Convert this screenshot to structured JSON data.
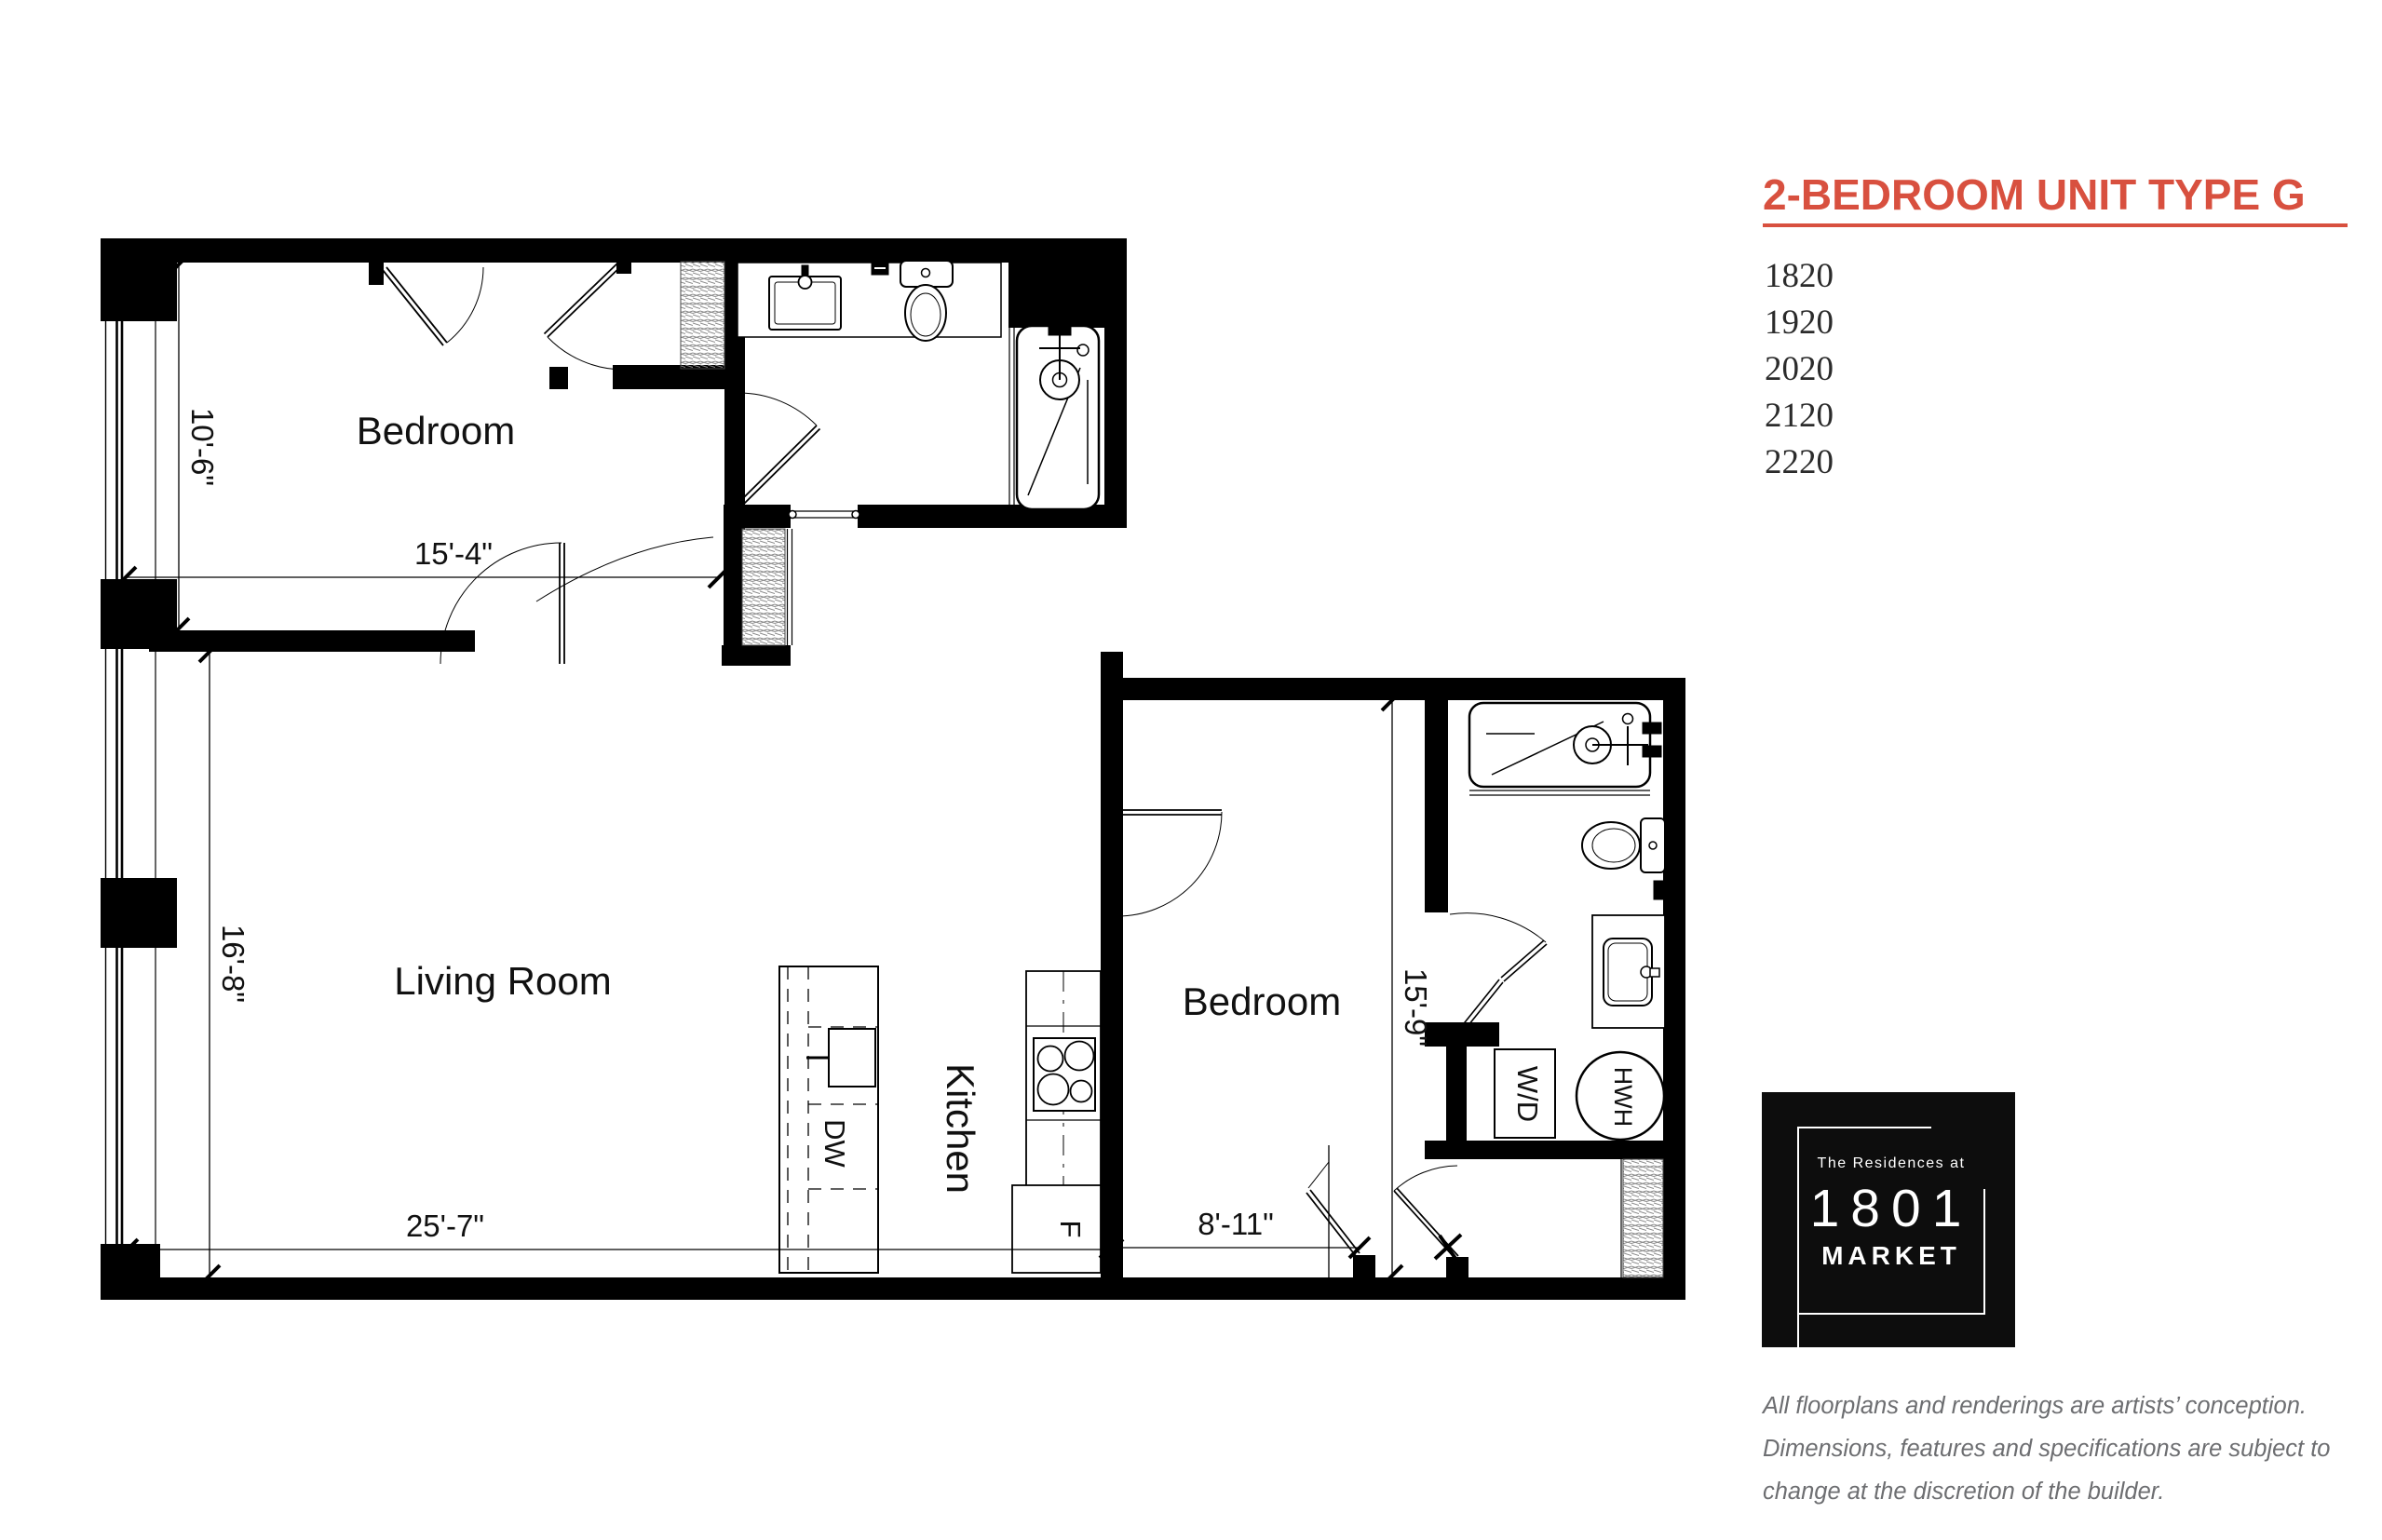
{
  "plan": {
    "bedroom1_label": "Bedroom",
    "living_label": "Living Room",
    "kitchen_label": "Kitchen",
    "bedroom2_label": "Bedroom",
    "dims": {
      "bedroom1_depth": "10'-6\"",
      "bedroom1_width": "15'-4\"",
      "living_depth": "16'-8\"",
      "living_width": "25'-7\"",
      "bedroom2_width": "8'-11\"",
      "bedroom2_depth": "15'-9\""
    },
    "appliances": {
      "dishwasher": "DW",
      "fridge": "F",
      "washer_dryer": "W/D",
      "water_heater": "HWH"
    }
  },
  "sidebar": {
    "title": "2-BEDROOM UNIT TYPE G",
    "accent_color": "#d8503f",
    "units": [
      "1820",
      "1920",
      "2020",
      "2120",
      "2220"
    ],
    "logo": {
      "tagline": "The Residences at",
      "number": "1801",
      "name": "MARKET"
    },
    "disclaimer": [
      "All floorplans and renderings are artists’ conception.",
      "Dimensions, features and specifications are subject to",
      "change at the discretion of the builder."
    ]
  }
}
